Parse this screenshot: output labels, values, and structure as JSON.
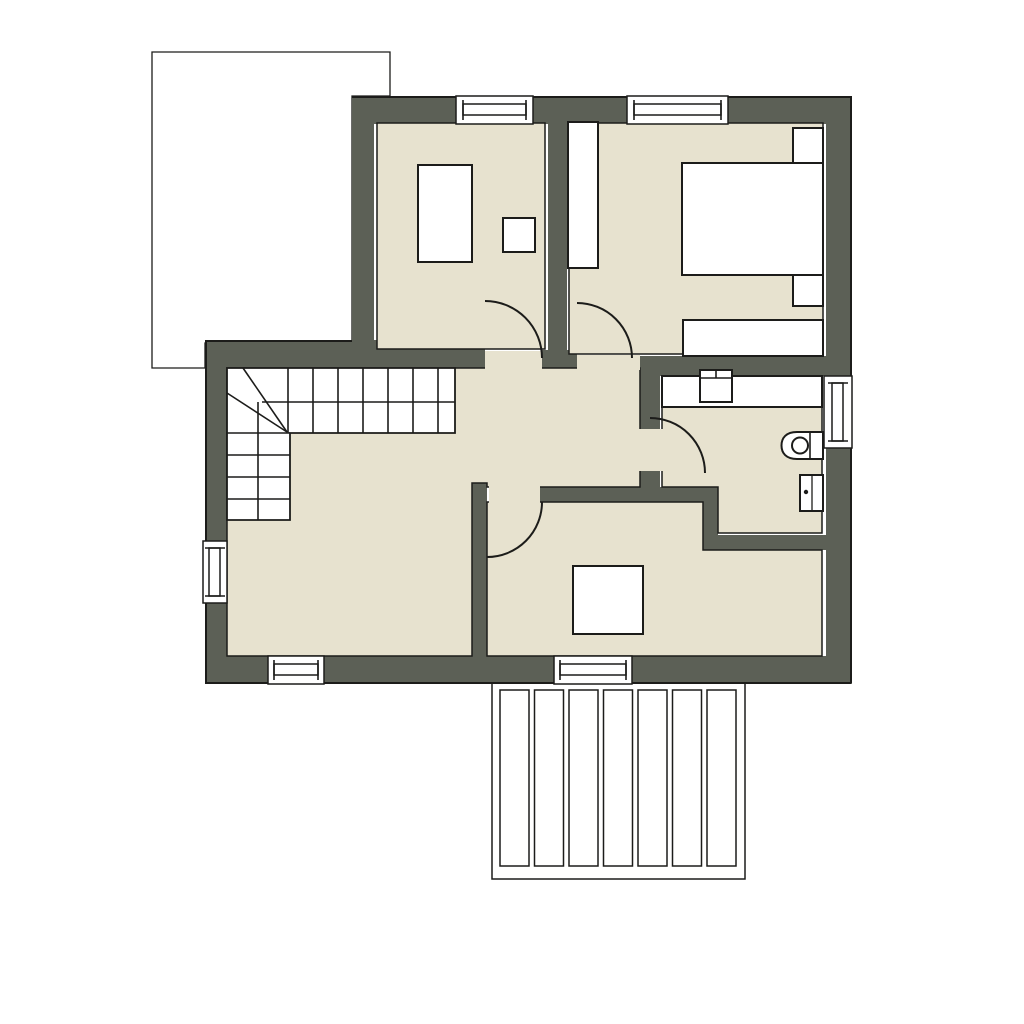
{
  "title": "upper-floor architectural plan",
  "colors": {
    "background": "#ffffff",
    "wall": "#5c6056",
    "floor": "#e7e2cf",
    "fixture": "#ffffff",
    "line": "#1c1c1a"
  },
  "plan": {
    "rooms": [
      {
        "name": "study"
      },
      {
        "name": "bedroom"
      },
      {
        "name": "hall-landing"
      },
      {
        "name": "bathroom"
      },
      {
        "name": "living-room"
      },
      {
        "name": "lower-room"
      }
    ],
    "stairs": {
      "shape": "L-winder",
      "upper-flight-treads": 8,
      "lower-flight-treads": 4
    },
    "windows_count": 6,
    "doors_count": 4,
    "furniture": [
      {
        "name": "desk",
        "room": "study"
      },
      {
        "name": "chair",
        "room": "study"
      },
      {
        "name": "wardrobe",
        "room": "bedroom"
      },
      {
        "name": "double-bed",
        "room": "bedroom"
      },
      {
        "name": "nightstand",
        "room": "bedroom"
      },
      {
        "name": "nightstand",
        "room": "bedroom"
      },
      {
        "name": "dresser",
        "room": "bedroom"
      },
      {
        "name": "vanity-counter",
        "room": "bathroom"
      },
      {
        "name": "sink",
        "room": "bathroom"
      },
      {
        "name": "toilet",
        "room": "bathroom"
      },
      {
        "name": "radiator",
        "room": "bathroom"
      },
      {
        "name": "square-table",
        "room": "lower-room"
      }
    ],
    "outdoor": [
      {
        "name": "hatched-terrace",
        "position": "top-left"
      },
      {
        "name": "plank-deck",
        "position": "bottom",
        "planks": 7
      }
    ]
  }
}
